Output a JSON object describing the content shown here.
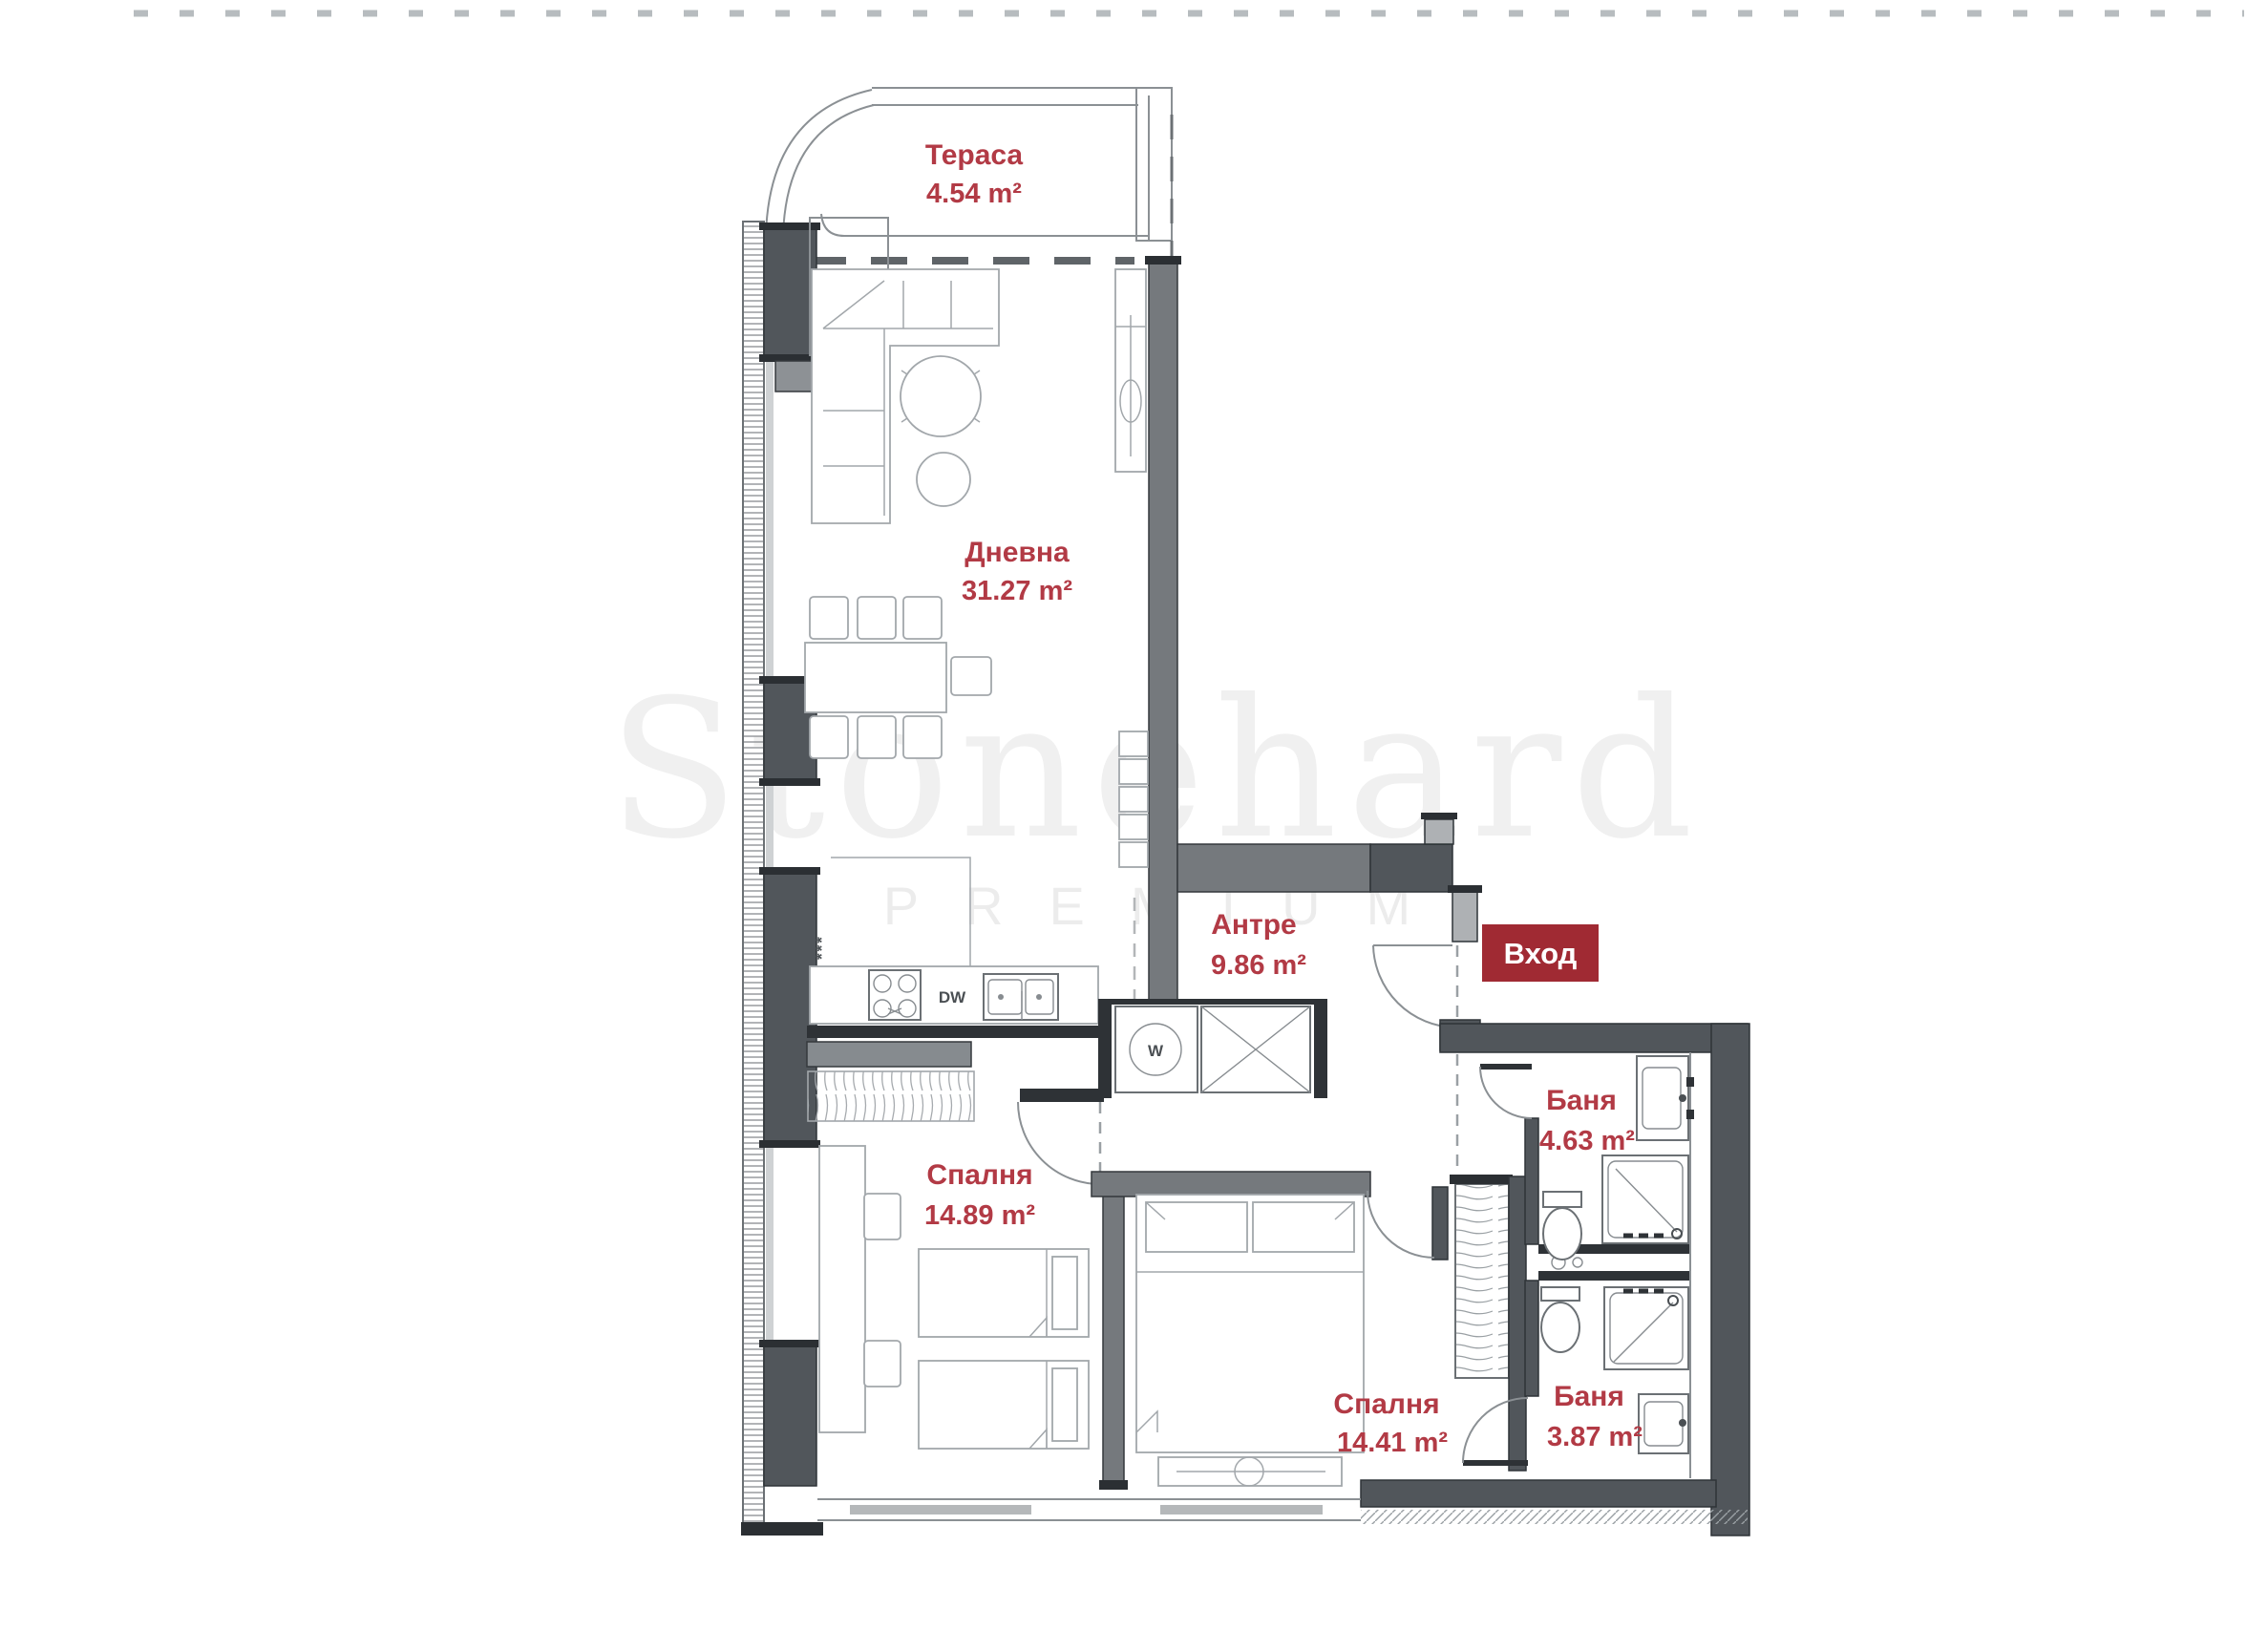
{
  "watermark": {
    "brand": "Stonehard",
    "tagline": "PREMIUM"
  },
  "rooms": {
    "terrace": {
      "name": "Тераса",
      "area": "4.54 m²"
    },
    "living": {
      "name": "Дневна",
      "area": "31.27 m²"
    },
    "hall": {
      "name": "Антре",
      "area": "9.86 m²"
    },
    "bathroom_1": {
      "name": "Баня",
      "area": "4.63 m²"
    },
    "bedroom_1": {
      "name": "Спалня",
      "area": "14.89 m²"
    },
    "bedroom_2": {
      "name": "Спалня",
      "area": "14.41 m²"
    },
    "bathroom_2": {
      "name": "Баня",
      "area": "3.87 m²"
    }
  },
  "entrance": {
    "label": "Вход"
  },
  "appliances": {
    "dishwasher": "DW",
    "washer": "W",
    "vent_marks": "***"
  },
  "colors": {
    "label_red": "#b23a45",
    "badge_red": "#a02a33",
    "wall_dark": "#51565b",
    "wall_mid": "#75797d",
    "wall_light": "#aeb1b4",
    "line_gray": "#8b9094",
    "furniture_gray": "#a2a7ab"
  }
}
